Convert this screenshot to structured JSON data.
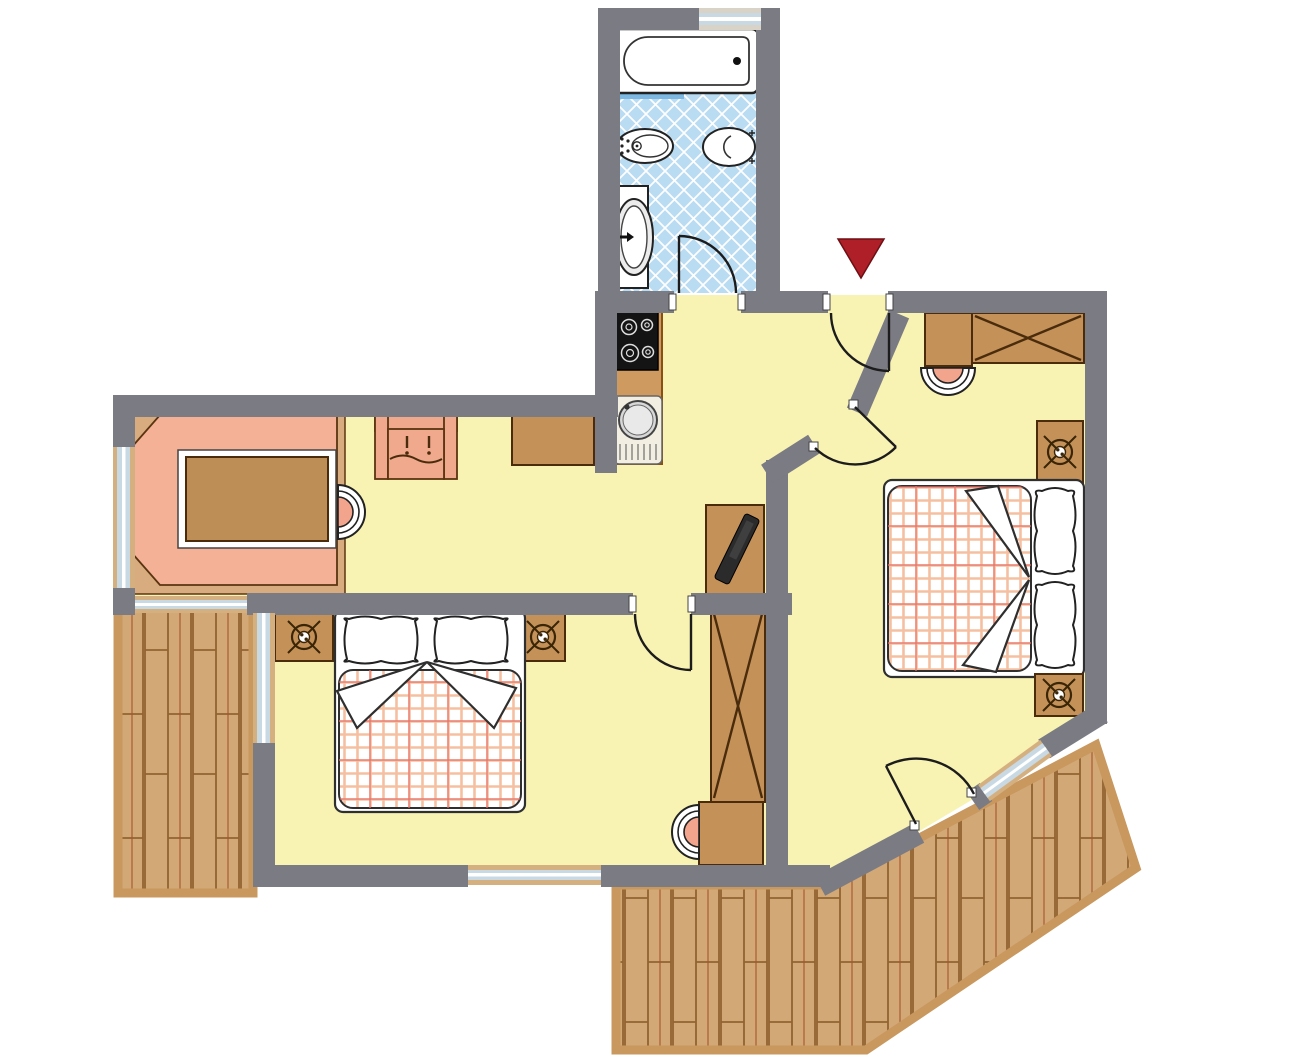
{
  "meta": {
    "title": "Apartment floor plan",
    "type": "architectural-floor-plan",
    "entrance_marker": "red-triangle-arrow-pointing-down-at-entrance-door"
  },
  "palette": {
    "wall": "#7b7b83",
    "floor": "#f8f3b3",
    "tile": "#badcf2",
    "tileLine": "#ffffff",
    "shelfBlue": "#7db8e2",
    "deckPlank": "#d2a876",
    "deckFrame": "#c8985e",
    "plankLine": "#916331",
    "plankAccent": "#a8542e",
    "furniture": "#c49258",
    "furnOutline": "#4a2c0c",
    "counter": "#cf9a5f",
    "counterOutline": "#8a4f14",
    "sofa": "#f4b196",
    "sofaBase": "#d8ac7e",
    "chairSeat": "#f2a58c",
    "tableTop": "#bd8e56",
    "linen": "#ffffff",
    "linenOutline": "#2f2f2f",
    "plaidLine": "#f3b089",
    "plaidAccent": "#e8716a",
    "glass": "#c9d9e4",
    "windowFrame": "#d4b080",
    "arrow": "#ae1f28",
    "arrowOutline": "#6d0f14",
    "stove": "#141414",
    "appliance": "#e9e6da",
    "lampInk": "#3a2507",
    "tv": "#2b2b2b"
  },
  "rooms": [
    {
      "id": "bathroom",
      "features": [
        "bathtub",
        "bidet",
        "toilet",
        "washbasin",
        "tiled-floor",
        "window"
      ]
    },
    {
      "id": "entrance-hall",
      "features": [
        "entrance-door",
        "entrance-arrow"
      ]
    },
    {
      "id": "kitchen",
      "features": [
        "counter",
        "stove-4-burners",
        "round-sink-with-drainer"
      ]
    },
    {
      "id": "living-room",
      "features": [
        "corner-bench-sofa",
        "dining-table",
        "chair",
        "armchair",
        "sideboard",
        "tv-on-stand",
        "window-left",
        "window-to-balcony"
      ]
    },
    {
      "id": "bedroom-left",
      "features": [
        "double-bed",
        "two-pillows",
        "plaid-blanket",
        "nightstand-with-lamp-x2",
        "wardrobe",
        "desk-with-chair",
        "window-left",
        "window-bottom"
      ]
    },
    {
      "id": "bedroom-right",
      "features": [
        "double-bed",
        "two-pillows",
        "plaid-blanket",
        "nightstand-with-lamp-x2",
        "wardrobe",
        "desk-with-chair",
        "door-to-terrace",
        "angled-window"
      ]
    },
    {
      "id": "balcony-left",
      "features": [
        "wood-plank-decking"
      ]
    },
    {
      "id": "terrace-right",
      "features": [
        "wood-plank-decking",
        "angled-shape"
      ]
    }
  ]
}
